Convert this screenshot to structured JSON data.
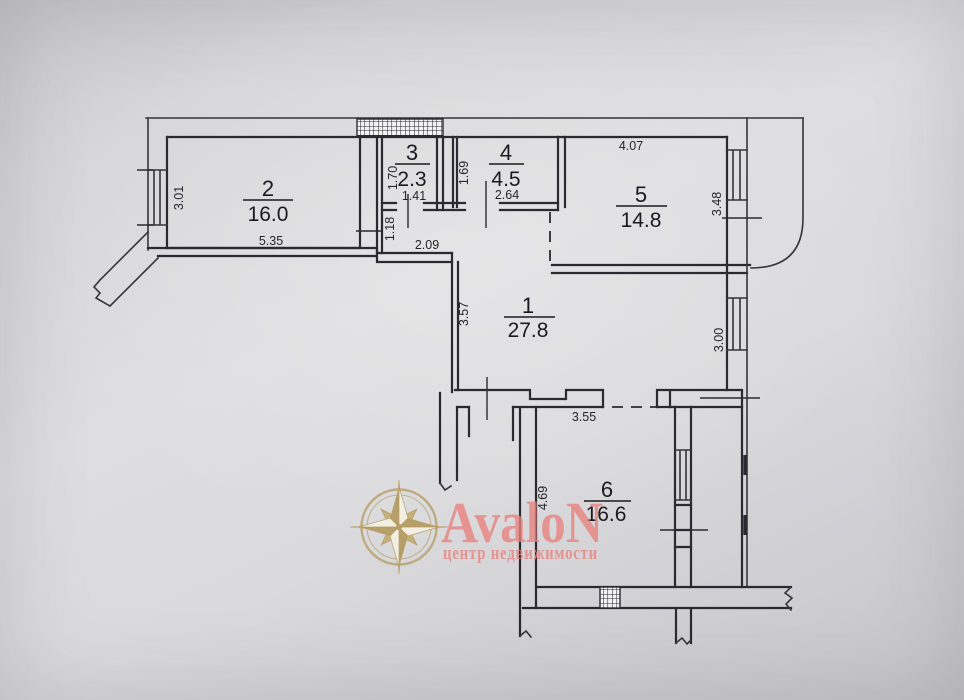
{
  "branding": {
    "name": "AvaloN",
    "tagline": "центр недвижимости",
    "text_color": "#e8827e",
    "gold": "#b2975a"
  },
  "plan": {
    "line_color": "#2b2a30",
    "rooms": [
      {
        "number": "1",
        "area": "27.8"
      },
      {
        "number": "2",
        "area": "16.0"
      },
      {
        "number": "3",
        "area": "2.3"
      },
      {
        "number": "4",
        "area": "4.5"
      },
      {
        "number": "5",
        "area": "14.8"
      },
      {
        "number": "6",
        "area": "16.6"
      }
    ],
    "dimensions": {
      "d301": "3.01",
      "d535": "5.35",
      "d170": "1.70",
      "d141": "1.41",
      "d118": "1.18",
      "d209": "2.09",
      "d169": "1.69",
      "d264": "2.64",
      "d407": "4.07",
      "d348": "3.48",
      "d357": "3.57",
      "d300": "3.00",
      "d355": "3.55",
      "d469": "4.69"
    }
  }
}
